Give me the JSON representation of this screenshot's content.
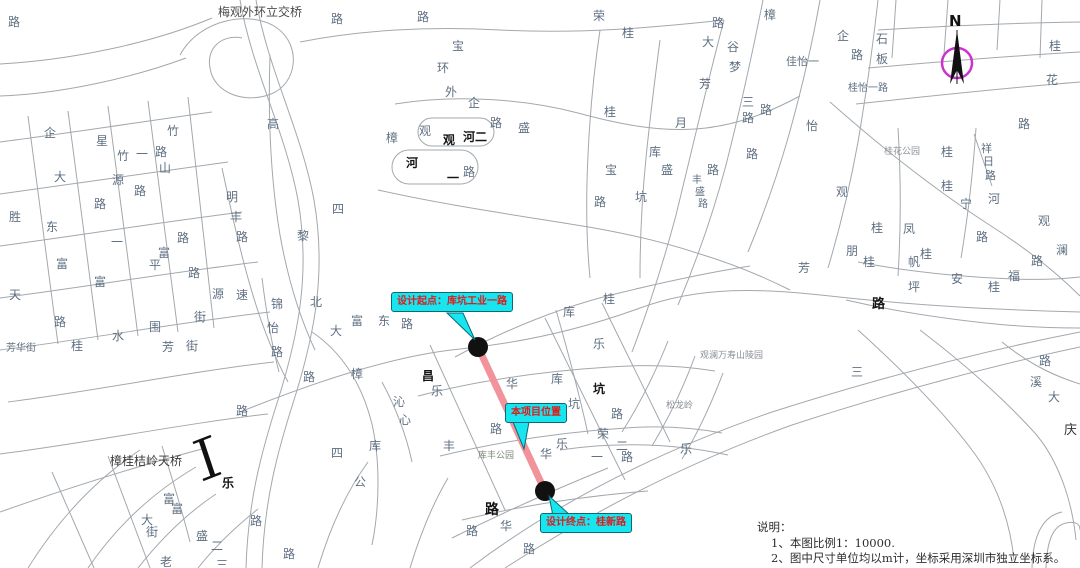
{
  "compass": {
    "label": "N"
  },
  "colors": {
    "route": "#F2939C",
    "route_endpoint": "#111111",
    "callout_bg": "#17E5EF",
    "callout_text": "#E01A1A",
    "compass_ring": "#CC33CC",
    "road_line": "#A3A8AD"
  },
  "callouts": [
    {
      "id": "design-start",
      "text": "设计起点：库坑工业一路"
    },
    {
      "id": "project-location",
      "text": "本项目位置"
    },
    {
      "id": "design-end",
      "text": "设计终点：桂新路"
    }
  ],
  "notes": {
    "heading": "说明：",
    "items": [
      "1、本图比例1：10000.",
      "2、图中尺寸单位均以m计，坐标采用深圳市独立坐标系。"
    ]
  },
  "map_labels": [
    {
      "t": "路",
      "x": 8,
      "y": 16
    },
    {
      "t": "梅观外环立交桥",
      "x": 218,
      "y": 6,
      "c": "#4a4a4a"
    },
    {
      "t": "路",
      "x": 331,
      "y": 13
    },
    {
      "t": "路",
      "x": 417,
      "y": 11
    },
    {
      "t": "宝",
      "x": 452,
      "y": 40
    },
    {
      "t": "环",
      "x": 437,
      "y": 62
    },
    {
      "t": "外",
      "x": 445,
      "y": 86
    },
    {
      "t": "企",
      "x": 468,
      "y": 97
    },
    {
      "t": "荣",
      "x": 593,
      "y": 10
    },
    {
      "t": "桂",
      "x": 622,
      "y": 27
    },
    {
      "t": "路",
      "x": 712,
      "y": 17
    },
    {
      "t": "大",
      "x": 702,
      "y": 36
    },
    {
      "t": "谷",
      "x": 727,
      "y": 41
    },
    {
      "t": "梦",
      "x": 729,
      "y": 61
    },
    {
      "t": "芳",
      "x": 699,
      "y": 78
    },
    {
      "t": "月",
      "x": 675,
      "y": 117
    },
    {
      "t": "樟",
      "x": 764,
      "y": 9
    },
    {
      "t": "企",
      "x": 837,
      "y": 30
    },
    {
      "t": "石",
      "x": 876,
      "y": 33
    },
    {
      "t": "板",
      "x": 876,
      "y": 53
    },
    {
      "t": "路",
      "x": 851,
      "y": 49
    },
    {
      "t": "佳怡一",
      "x": 786,
      "y": 56,
      "s": 11
    },
    {
      "t": "桂怡一路",
      "x": 848,
      "y": 84,
      "s": 10
    },
    {
      "t": "三",
      "x": 742,
      "y": 96
    },
    {
      "t": "路",
      "x": 742,
      "y": 112
    },
    {
      "t": "怡",
      "x": 806,
      "y": 120
    },
    {
      "t": "桂",
      "x": 1049,
      "y": 40
    },
    {
      "t": "花",
      "x": 1046,
      "y": 74
    },
    {
      "t": "路",
      "x": 1018,
      "y": 118
    },
    {
      "t": "观",
      "x": 419,
      "y": 125
    },
    {
      "t": "观",
      "x": 443,
      "y": 134,
      "b": 1
    },
    {
      "t": "河二",
      "x": 463,
      "y": 131,
      "b": 1
    },
    {
      "t": "路",
      "x": 490,
      "y": 117
    },
    {
      "t": "盛",
      "x": 518,
      "y": 122
    },
    {
      "t": "河",
      "x": 406,
      "y": 157,
      "b": 1
    },
    {
      "t": "一",
      "x": 447,
      "y": 172,
      "b": 1
    },
    {
      "t": "路",
      "x": 463,
      "y": 166
    },
    {
      "t": "高",
      "x": 267,
      "y": 118
    },
    {
      "t": "樟",
      "x": 386,
      "y": 132
    },
    {
      "t": "四",
      "x": 332,
      "y": 203
    },
    {
      "t": "黎",
      "x": 297,
      "y": 230
    },
    {
      "t": "明",
      "x": 226,
      "y": 191
    },
    {
      "t": "丰",
      "x": 230,
      "y": 211
    },
    {
      "t": "路",
      "x": 236,
      "y": 231
    },
    {
      "t": "桂",
      "x": 604,
      "y": 106
    },
    {
      "t": "库",
      "x": 649,
      "y": 146
    },
    {
      "t": "盛",
      "x": 661,
      "y": 164
    },
    {
      "t": "路",
      "x": 707,
      "y": 164
    },
    {
      "t": "宝",
      "x": 605,
      "y": 164
    },
    {
      "t": "丰",
      "x": 692,
      "y": 176,
      "s": 10
    },
    {
      "t": "盛",
      "x": 695,
      "y": 188,
      "s": 10
    },
    {
      "t": "路",
      "x": 698,
      "y": 200,
      "s": 10
    },
    {
      "t": "坑",
      "x": 635,
      "y": 191
    },
    {
      "t": "路",
      "x": 594,
      "y": 196
    },
    {
      "t": "路",
      "x": 760,
      "y": 104
    },
    {
      "t": "路",
      "x": 746,
      "y": 148
    },
    {
      "t": "桂花公园",
      "x": 884,
      "y": 148,
      "s": 9,
      "c": "#8a8f98"
    },
    {
      "t": "桂",
      "x": 941,
      "y": 146
    },
    {
      "t": "桂",
      "x": 941,
      "y": 180
    },
    {
      "t": "祥",
      "x": 981,
      "y": 143,
      "s": 11
    },
    {
      "t": "日",
      "x": 983,
      "y": 156,
      "s": 11
    },
    {
      "t": "路",
      "x": 985,
      "y": 170,
      "s": 11
    },
    {
      "t": "河",
      "x": 988,
      "y": 193
    },
    {
      "t": "宁",
      "x": 960,
      "y": 198
    },
    {
      "t": "观",
      "x": 1038,
      "y": 215
    },
    {
      "t": "澜",
      "x": 1056,
      "y": 244
    },
    {
      "t": "路",
      "x": 1031,
      "y": 255
    },
    {
      "t": "桂",
      "x": 871,
      "y": 222
    },
    {
      "t": "凤",
      "x": 903,
      "y": 223
    },
    {
      "t": "路",
      "x": 976,
      "y": 231
    },
    {
      "t": "观",
      "x": 836,
      "y": 186
    },
    {
      "t": "朋",
      "x": 846,
      "y": 245
    },
    {
      "t": "桂",
      "x": 920,
      "y": 248
    },
    {
      "t": "帆",
      "x": 908,
      "y": 256
    },
    {
      "t": "桂",
      "x": 863,
      "y": 256
    },
    {
      "t": "芳",
      "x": 798,
      "y": 262
    },
    {
      "t": "坪",
      "x": 908,
      "y": 281
    },
    {
      "t": "安",
      "x": 951,
      "y": 273
    },
    {
      "t": "福",
      "x": 1008,
      "y": 270
    },
    {
      "t": "桂",
      "x": 988,
      "y": 281
    },
    {
      "t": "路",
      "x": 872,
      "y": 298,
      "b": 1,
      "s": 13
    },
    {
      "t": "三",
      "x": 851,
      "y": 366
    },
    {
      "t": "观澜万寿山陵园",
      "x": 700,
      "y": 352,
      "s": 9,
      "c": "#8a8f98"
    },
    {
      "t": "松龙岭",
      "x": 666,
      "y": 402,
      "s": 9,
      "c": "#8a8f98"
    },
    {
      "t": "乐",
      "x": 680,
      "y": 443
    },
    {
      "t": "溪",
      "x": 1030,
      "y": 376
    },
    {
      "t": "大",
      "x": 1048,
      "y": 391
    },
    {
      "t": "路",
      "x": 1039,
      "y": 355
    },
    {
      "t": "庆",
      "x": 1064,
      "y": 424,
      "s": 13,
      "c": "#333333"
    },
    {
      "t": "企",
      "x": 44,
      "y": 127
    },
    {
      "t": "星",
      "x": 96,
      "y": 135
    },
    {
      "t": "竹",
      "x": 167,
      "y": 125
    },
    {
      "t": "竹",
      "x": 117,
      "y": 150
    },
    {
      "t": "一",
      "x": 136,
      "y": 148
    },
    {
      "t": "路",
      "x": 155,
      "y": 146
    },
    {
      "t": "山",
      "x": 159,
      "y": 162
    },
    {
      "t": "大",
      "x": 54,
      "y": 171
    },
    {
      "t": "源",
      "x": 112,
      "y": 174
    },
    {
      "t": "路",
      "x": 134,
      "y": 185
    },
    {
      "t": "路",
      "x": 94,
      "y": 198
    },
    {
      "t": "胜",
      "x": 9,
      "y": 211
    },
    {
      "t": "东",
      "x": 46,
      "y": 221
    },
    {
      "t": "路",
      "x": 177,
      "y": 232
    },
    {
      "t": "一",
      "x": 111,
      "y": 236
    },
    {
      "t": "富",
      "x": 158,
      "y": 247
    },
    {
      "t": "平",
      "x": 149,
      "y": 259
    },
    {
      "t": "富",
      "x": 56,
      "y": 258
    },
    {
      "t": "路",
      "x": 188,
      "y": 267
    },
    {
      "t": "富",
      "x": 94,
      "y": 276
    },
    {
      "t": "天",
      "x": 9,
      "y": 289
    },
    {
      "t": "路",
      "x": 54,
      "y": 316
    },
    {
      "t": "水",
      "x": 112,
      "y": 330
    },
    {
      "t": "围",
      "x": 149,
      "y": 321
    },
    {
      "t": "街",
      "x": 194,
      "y": 311
    },
    {
      "t": "芳",
      "x": 162,
      "y": 341
    },
    {
      "t": "街",
      "x": 186,
      "y": 340
    },
    {
      "t": "桂",
      "x": 71,
      "y": 340
    },
    {
      "t": "芳华街",
      "x": 6,
      "y": 344,
      "s": 10
    },
    {
      "t": "源",
      "x": 212,
      "y": 288
    },
    {
      "t": "速",
      "x": 236,
      "y": 289
    },
    {
      "t": "锦",
      "x": 271,
      "y": 298
    },
    {
      "t": "怡",
      "x": 267,
      "y": 322
    },
    {
      "t": "路",
      "x": 271,
      "y": 346
    },
    {
      "t": "北",
      "x": 310,
      "y": 296
    },
    {
      "t": "大",
      "x": 330,
      "y": 325
    },
    {
      "t": "富",
      "x": 351,
      "y": 315
    },
    {
      "t": "东",
      "x": 378,
      "y": 315
    },
    {
      "t": "路",
      "x": 401,
      "y": 318
    },
    {
      "t": "路",
      "x": 303,
      "y": 371
    },
    {
      "t": "樟",
      "x": 351,
      "y": 368
    },
    {
      "t": "沁",
      "x": 393,
      "y": 396
    },
    {
      "t": "心",
      "x": 399,
      "y": 414
    },
    {
      "t": "路",
      "x": 236,
      "y": 405
    },
    {
      "t": "四",
      "x": 331,
      "y": 447
    },
    {
      "t": "公",
      "x": 354,
      "y": 476
    },
    {
      "t": "库",
      "x": 369,
      "y": 440
    },
    {
      "t": "丰",
      "x": 443,
      "y": 440
    },
    {
      "t": "路",
      "x": 490,
      "y": 423
    },
    {
      "t": "樟桂桔岭天桥",
      "x": 110,
      "y": 455,
      "c": "#3a3a3a"
    },
    {
      "t": "乐",
      "x": 222,
      "y": 477,
      "b": 1
    },
    {
      "t": "富",
      "x": 163,
      "y": 493
    },
    {
      "t": "富",
      "x": 171,
      "y": 503
    },
    {
      "t": "大",
      "x": 141,
      "y": 514
    },
    {
      "t": "街",
      "x": 146,
      "y": 526
    },
    {
      "t": "盛",
      "x": 196,
      "y": 530
    },
    {
      "t": "二",
      "x": 211,
      "y": 540
    },
    {
      "t": "路",
      "x": 250,
      "y": 515
    },
    {
      "t": "路",
      "x": 283,
      "y": 548
    },
    {
      "t": "老",
      "x": 160,
      "y": 556
    },
    {
      "t": "三",
      "x": 216,
      "y": 559
    },
    {
      "t": "桂",
      "x": 497,
      "y": 298
    },
    {
      "t": "桂",
      "x": 603,
      "y": 293
    },
    {
      "t": "库",
      "x": 563,
      "y": 306
    },
    {
      "t": "乐",
      "x": 593,
      "y": 338
    },
    {
      "t": "昌",
      "x": 422,
      "y": 370,
      "b": 1
    },
    {
      "t": "乐",
      "x": 431,
      "y": 385
    },
    {
      "t": "华",
      "x": 506,
      "y": 378
    },
    {
      "t": "库",
      "x": 551,
      "y": 373
    },
    {
      "t": "坑",
      "x": 593,
      "y": 383,
      "b": 1
    },
    {
      "t": "坑",
      "x": 568,
      "y": 398
    },
    {
      "t": "路",
      "x": 611,
      "y": 408
    },
    {
      "t": "荣",
      "x": 597,
      "y": 428
    },
    {
      "t": "一",
      "x": 591,
      "y": 451
    },
    {
      "t": "二",
      "x": 616,
      "y": 440
    },
    {
      "t": "路",
      "x": 621,
      "y": 451
    },
    {
      "t": "乐",
      "x": 556,
      "y": 438
    },
    {
      "t": "华",
      "x": 540,
      "y": 448
    },
    {
      "t": "库丰公园",
      "x": 478,
      "y": 452,
      "s": 9,
      "c": "#7a8a7a"
    },
    {
      "t": "路",
      "x": 485,
      "y": 503,
      "b": 1,
      "s": 14
    },
    {
      "t": "华",
      "x": 500,
      "y": 520
    },
    {
      "t": "路",
      "x": 466,
      "y": 525
    },
    {
      "t": "路",
      "x": 523,
      "y": 543
    }
  ]
}
